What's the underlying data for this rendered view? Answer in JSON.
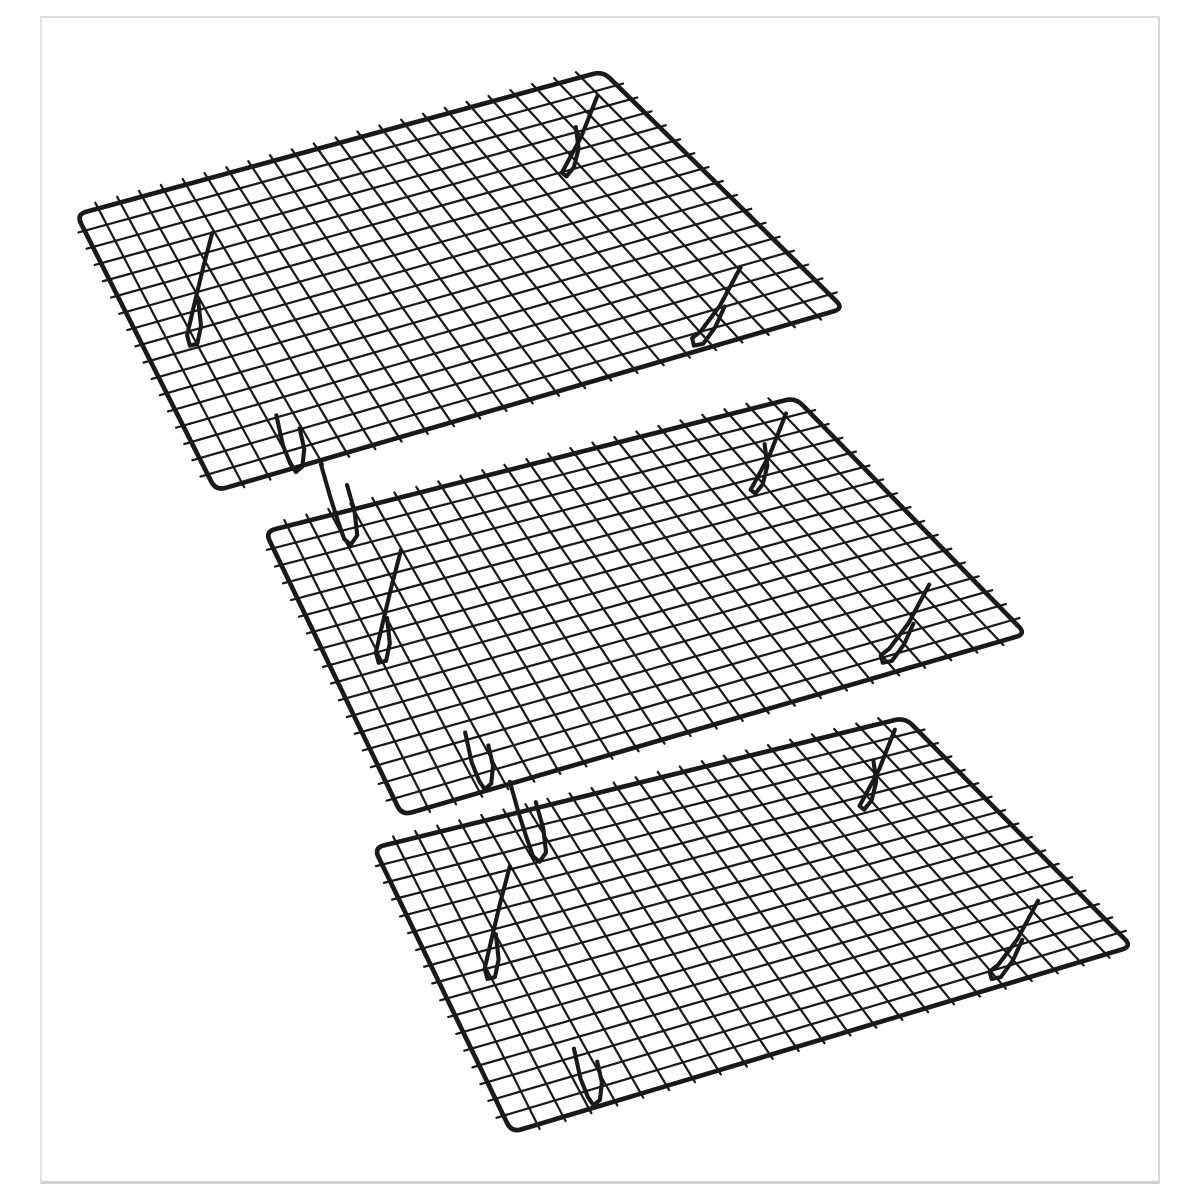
{
  "scene": {
    "description": "Product photo: set of 3 identical black non-stick wire cooling racks, shown diagonally from top-left to bottom-right on a plain white background",
    "rack_count": 3,
    "background_color": "#ffffff",
    "photo_border_color": "#d9d9d9",
    "wire_color": "#191919",
    "grid": {
      "columns": 24,
      "rows": 17,
      "stub_back_uv": 0.021,
      "stub_front_uv": 0.015,
      "stub_side_uv": 0.0115
    },
    "style": {
      "frame_stroke": 5,
      "grid_stroke": 2.4,
      "leg_stroke": 4.4,
      "corner_radius": 11
    },
    "racks": [
      {
        "name": "cooling-rack-top",
        "corners": {
          "w": [
            37,
            186
          ],
          "n": [
            603,
            32
          ],
          "e": [
            862,
            287
          ],
          "s": [
            187,
            483
          ]
        },
        "legs": [
          "back_left",
          "back_right",
          "front_left",
          "front_right",
          "front_hanging"
        ]
      },
      {
        "name": "cooling-rack-middle",
        "corners": {
          "w": [
            240,
            527
          ],
          "n": [
            810,
            383
          ],
          "e": [
            1058,
            637
          ],
          "s": [
            387,
            832
          ]
        },
        "legs": [
          "back_left",
          "back_right",
          "front_left",
          "front_right",
          "front_hanging"
        ]
      },
      {
        "name": "cooling-rack-bottom",
        "corners": {
          "w": [
            357,
            867
          ],
          "n": [
            928,
            727
          ],
          "e": [
            1172,
            973
          ],
          "s": [
            505,
            1173
          ]
        },
        "legs": [
          "back_left",
          "back_right",
          "front_left",
          "front_right"
        ]
      }
    ],
    "leg_shapes": {
      "back_left": [
        [
          146,
          20
        ],
        [
          136,
          58
        ],
        [
          125,
          104
        ],
        [
          119,
          130
        ],
        [
          122,
          141
        ],
        [
          130,
          139
        ],
        [
          134,
          120
        ],
        [
          131,
          93
        ]
      ],
      "back_right": [
        [
          560,
          -127
        ],
        [
          543,
          -84
        ],
        [
          528,
          -56
        ],
        [
          522,
          -45
        ],
        [
          527,
          -41
        ],
        [
          535,
          -51
        ],
        [
          540,
          -71
        ],
        [
          537,
          -94
        ]
      ],
      "front_left": [
        [
          215,
          216
        ],
        [
          222,
          248
        ],
        [
          230,
          268
        ],
        [
          236,
          277
        ],
        [
          243,
          271
        ],
        [
          245,
          252
        ],
        [
          240,
          230
        ]
      ],
      "front_right": [
        [
          714,
          57
        ],
        [
          692,
          98
        ],
        [
          671,
          126
        ],
        [
          662,
          133
        ],
        [
          664,
          141
        ],
        [
          674,
          139
        ],
        [
          687,
          121
        ],
        [
          697,
          99
        ]
      ],
      "front_hanging": [
        [
          263,
          269
        ],
        [
          273,
          304
        ],
        [
          281,
          329
        ],
        [
          288,
          349
        ],
        [
          295,
          355
        ],
        [
          302,
          345
        ],
        [
          299,
          319
        ],
        [
          291,
          291
        ]
      ]
    }
  }
}
